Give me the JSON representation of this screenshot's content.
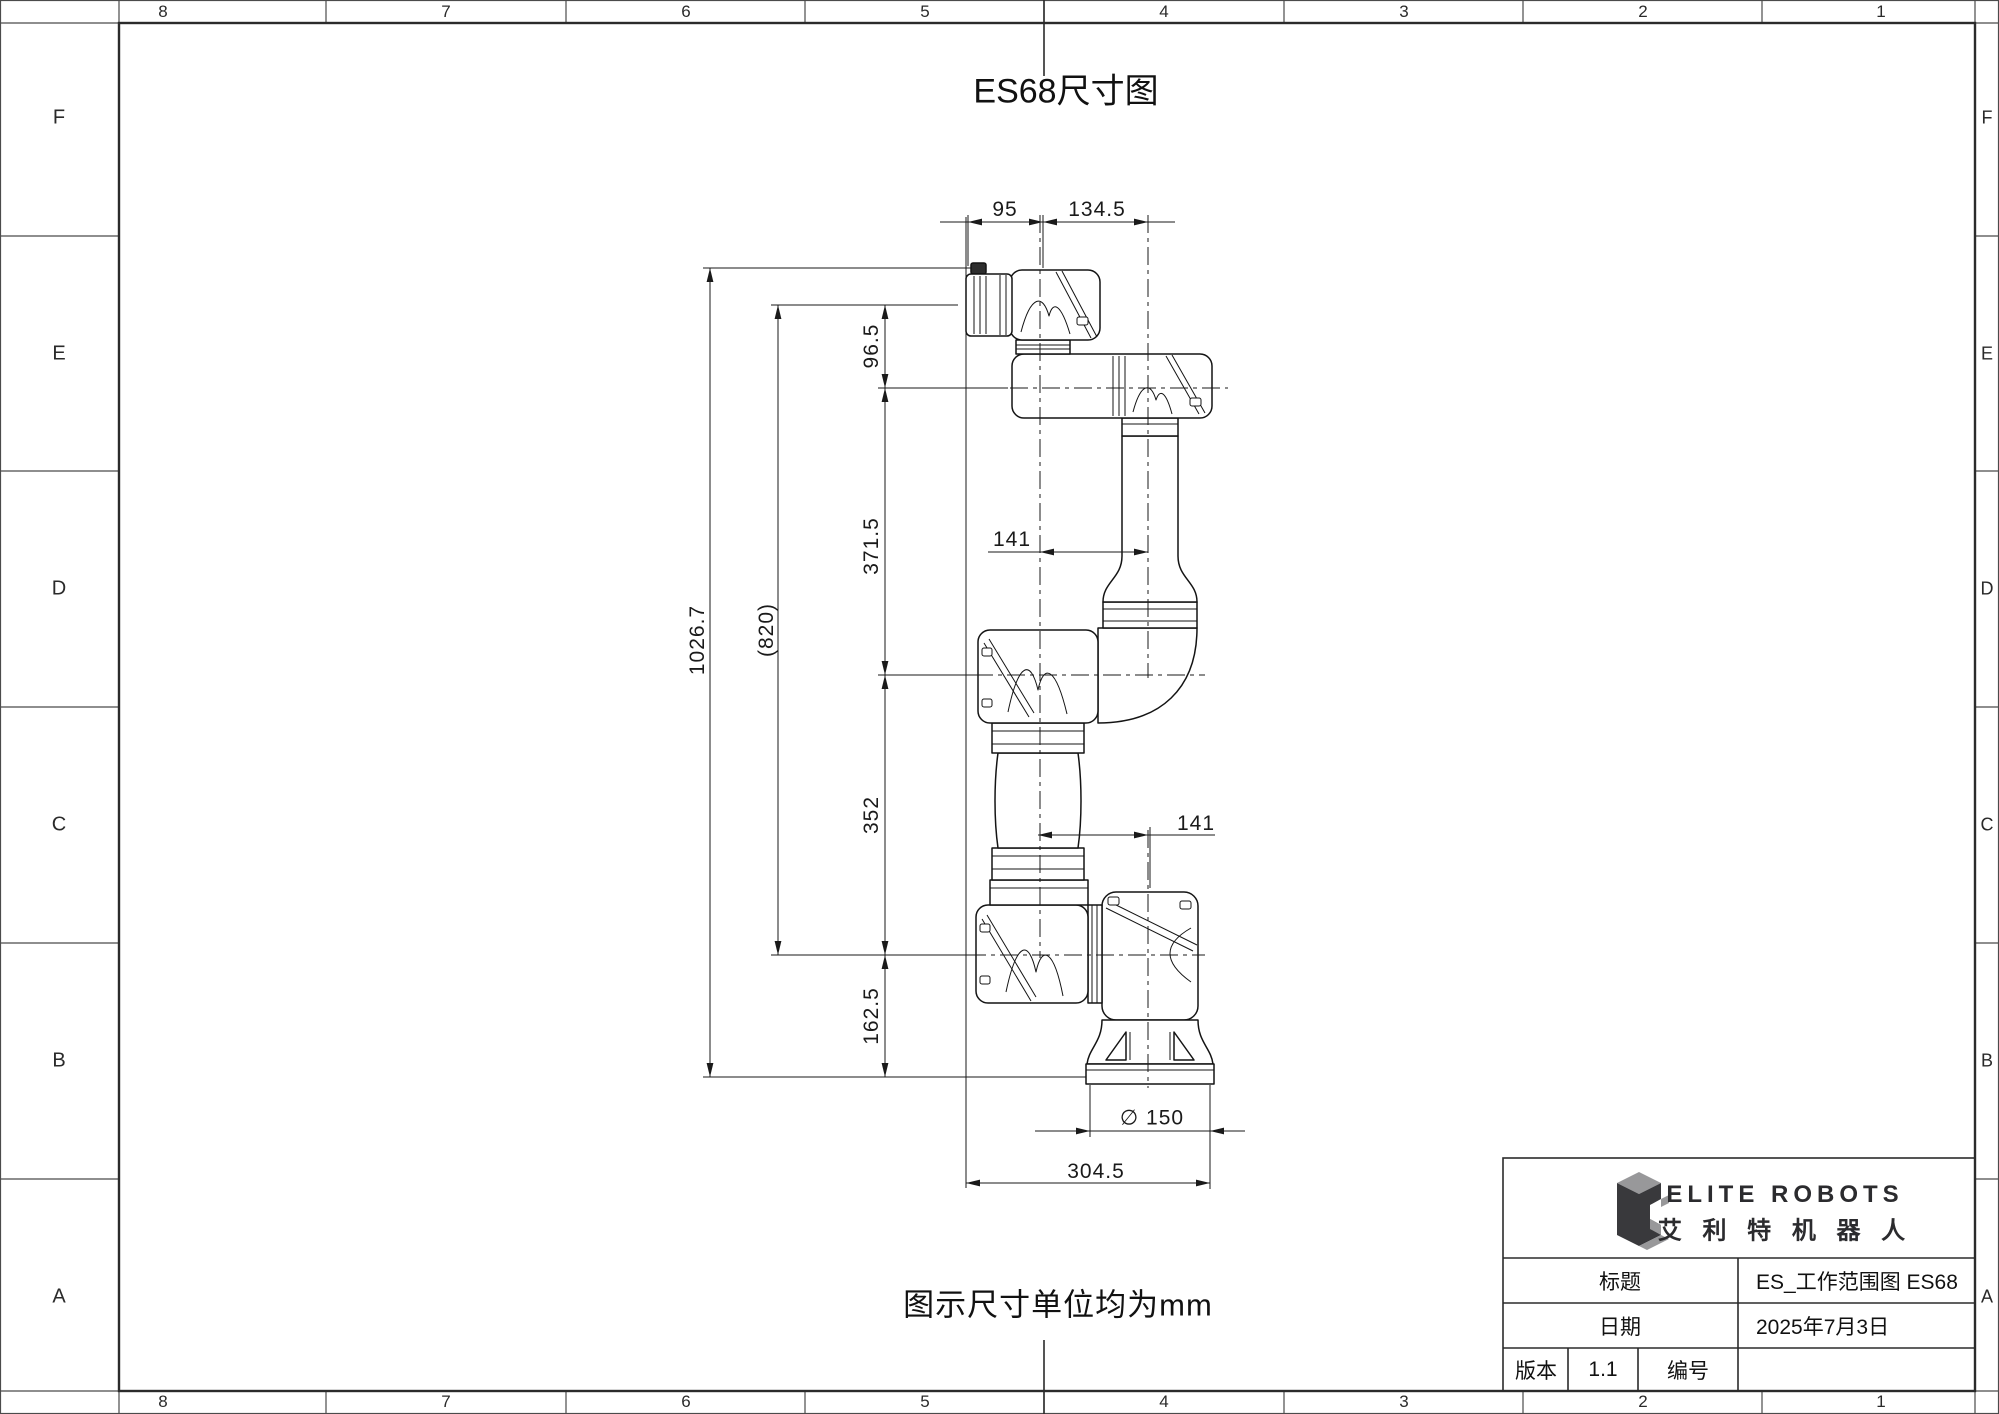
{
  "title": "ES68尺寸图",
  "note": "图示尺寸单位均为mm",
  "border": {
    "top": [
      "8",
      "7",
      "6",
      "5",
      "4",
      "3",
      "2",
      "1"
    ],
    "bottom": [
      "8",
      "7",
      "6",
      "5",
      "4",
      "3",
      "2",
      "1"
    ],
    "left": [
      "F",
      "E",
      "D",
      "C",
      "B",
      "A"
    ],
    "right": [
      "F",
      "E",
      "D",
      "C",
      "B",
      "A"
    ]
  },
  "dimensions": {
    "top_width_left": "95",
    "top_width_right": "134.5",
    "flange_to_wrist": "96.5",
    "wrist_to_elbow": "371.5",
    "elbow_to_shoulder": "352",
    "shoulder_to_base": "162.5",
    "total_height": "1026.7",
    "flange_to_shoulder": "(820)",
    "wrist_offset": "141",
    "elbow_offset": "141",
    "base_diameter": "∅ 150",
    "base_width": "304.5"
  },
  "title_block": {
    "logo_name": "ELITE ROBOTS",
    "logo_name_cn": "艾 利 特 机 器 人",
    "title_label": "标题",
    "title_value": "ES_工作范围图  ES68",
    "date_label": "日期",
    "date_value": "2025年7月3日",
    "version_label": "版本",
    "version_value": "1.1",
    "number_label": "编号",
    "number_value": ""
  },
  "colors": {
    "line": "#1a1a1a",
    "frame": "#2b2b2b",
    "logo_dark": "#39393c",
    "logo_light": "#98989a"
  }
}
